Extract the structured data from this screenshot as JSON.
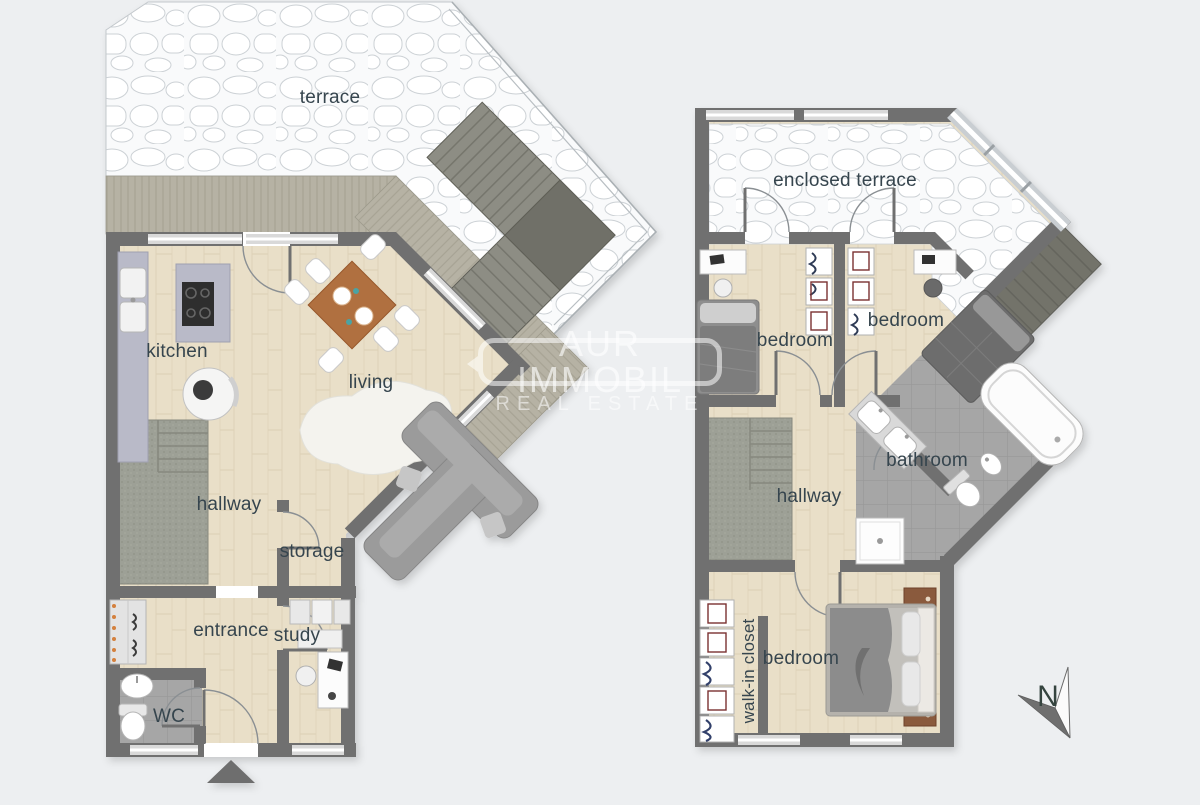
{
  "canvas": {
    "bg": "#edeff1"
  },
  "branding": {
    "brand": "AUR IMMOBIL",
    "tagline": "REAL ESTATE"
  },
  "compass": {
    "north_label": "N"
  },
  "ground_floor": {
    "rooms": {
      "terrace": "terrace",
      "kitchen": "kitchen",
      "living": "living",
      "hallway": "hallway",
      "storage": "storage",
      "entrance": "entrance",
      "study": "study",
      "wc": "WC"
    }
  },
  "upper_floor": {
    "rooms": {
      "enclosed_terrace": "enclosed terrace",
      "bedroom_front": "bedroom",
      "bedroom_middle": "bedroom",
      "bathroom": "bathroom",
      "hallway": "hallway",
      "walk_in_closet": "walk-in closet",
      "bedroom_main": "bedroom"
    }
  },
  "palette": {
    "wall": "#6f6f6f",
    "wood_floor": "#e9dfc8",
    "stone": "#fafbfc",
    "deck": "#b6b2a4",
    "tile": "#a4a4a4",
    "carpet": "#9da096",
    "label": "#36454e",
    "accent_wood": "#b06f3f"
  }
}
